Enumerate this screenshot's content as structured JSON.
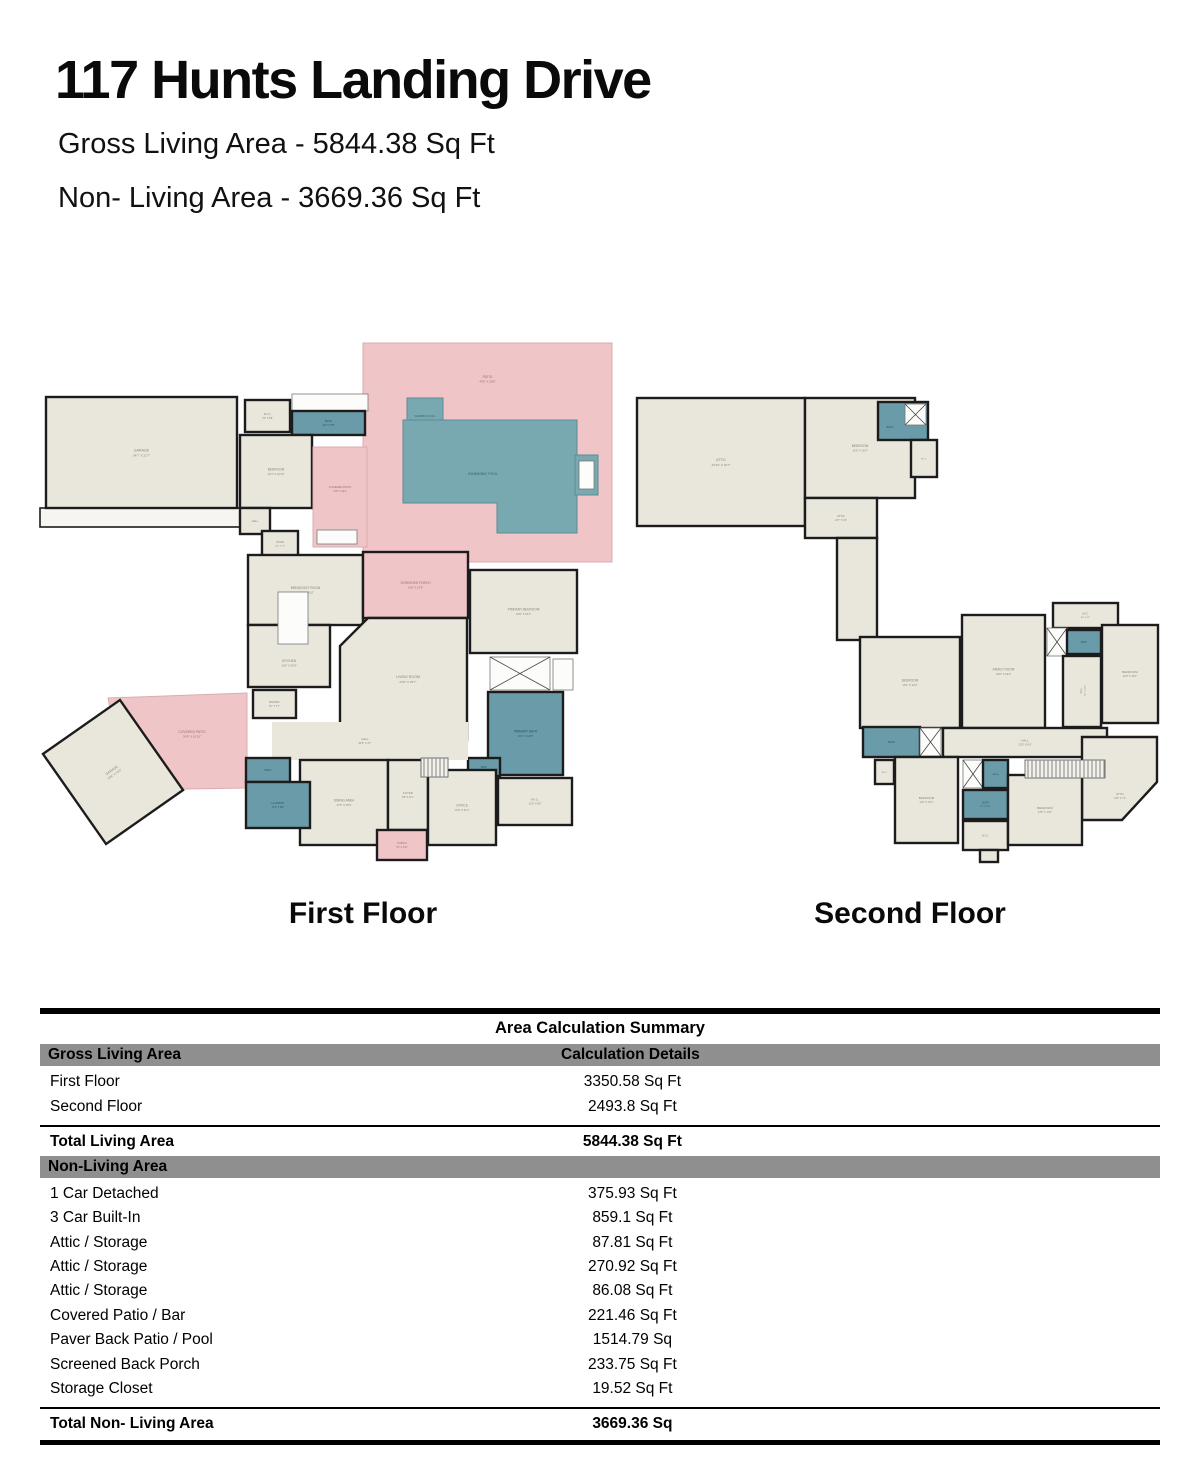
{
  "header": {
    "title": "117 Hunts Landing Drive",
    "gross": "Gross Living Area - 5844.38 Sq Ft",
    "nonliving": "Non- Living Area - 3669.36 Sq Ft"
  },
  "colors": {
    "wall": "#1c1c1c",
    "room_fill": "#e9e7dc",
    "bath_fill": "#699ca8",
    "pool_fill": "#79a9b0",
    "patio_fill": "#f0c5c8"
  },
  "plans": {
    "first": {
      "label": "First Floor",
      "shapes": [
        {
          "k": "patio",
          "x": 363,
          "y": 23,
          "w": 249,
          "h": 219,
          "n": "PATIO",
          "d": "43'6\" X 38'0\"",
          "ly": 58
        },
        {
          "k": "patio",
          "pts": "108,378 247,373 247,468 126,470",
          "n": "COVERED PATIO",
          "d": "24'8\" X 16'10\"",
          "lx": 192,
          "ly": 413
        },
        {
          "k": "pool",
          "x": 407,
          "y": 78,
          "w": 36,
          "h": 39,
          "n": "WARMING POOL",
          "fs": 2.6,
          "ly": 97
        },
        {
          "k": "pool",
          "pts": "403,100 577,100 577,213 497,213 497,183 403,183",
          "n": "SWIMMING POOL",
          "lx": 483,
          "ly": 155,
          "fs": 3.6
        },
        {
          "k": "pool",
          "x": 575,
          "y": 135,
          "w": 23,
          "h": 40
        },
        {
          "k": "white",
          "x": 579,
          "y": 141,
          "w": 15,
          "h": 28
        },
        {
          "k": "strip",
          "x": 40,
          "y": 188,
          "w": 205,
          "h": 19
        },
        {
          "k": "room",
          "x": 46,
          "y": 77,
          "w": 191,
          "h": 111,
          "n": "GARAGE",
          "d": "34'7\" X 22'7\"",
          "fs": 3.6
        },
        {
          "k": "room",
          "x": 245,
          "y": 80,
          "w": 45,
          "h": 32,
          "n": "W.I.C.",
          "d": "4'4\" X 5'8\"",
          "fs": 2.8
        },
        {
          "k": "white",
          "x": 292,
          "y": 74,
          "w": 76,
          "h": 17
        },
        {
          "k": "bath",
          "x": 292,
          "y": 91,
          "w": 73,
          "h": 24,
          "n": "BATH",
          "d": "10'4\" X 5'8\"",
          "fs": 2.8
        },
        {
          "k": "room",
          "x": 240,
          "y": 115,
          "w": 72,
          "h": 73,
          "n": "BEDROOM",
          "d": "12'4\" X 12'10\"",
          "fs": 3.2
        },
        {
          "k": "patio",
          "x": 313,
          "y": 127,
          "w": 54,
          "h": 100,
          "n": "COVERED PATIO",
          "d": "13'8\" X 16'4\"",
          "fs": 2.8,
          "ly": 168
        },
        {
          "k": "white",
          "x": 317,
          "y": 210,
          "w": 40,
          "h": 14
        },
        {
          "k": "room",
          "x": 240,
          "y": 188,
          "w": 30,
          "h": 26,
          "n": "HALL",
          "fs": 2.6
        },
        {
          "k": "room",
          "x": 262,
          "y": 211,
          "w": 36,
          "h": 26,
          "n": "ROOM",
          "d": "10'0\" X 7'5\"",
          "fs": 2.4
        },
        {
          "k": "room",
          "x": 248,
          "y": 235,
          "w": 115,
          "h": 70,
          "n": "BREAKFAST ROOM",
          "d": "16'5\" X 16'10\"",
          "fs": 3.2
        },
        {
          "k": "room",
          "x": 248,
          "y": 305,
          "w": 82,
          "h": 62,
          "n": "KITCHEN",
          "d": "16'4\" X 20'8\"",
          "fs": 3.2,
          "ly": 342
        },
        {
          "k": "room",
          "x": 253,
          "y": 370,
          "w": 43,
          "h": 28,
          "n": "PANTRY",
          "d": "8'7\" X 7'7\"",
          "fs": 2.8
        },
        {
          "k": "patioRoom",
          "x": 363,
          "y": 232,
          "w": 105,
          "h": 66,
          "n": "SCREENED PORCH",
          "d": "16'8\" X 13'9\"",
          "fs": 3.2
        },
        {
          "k": "room",
          "pts": "368,298 467,298 467,420 340,420 340,326",
          "n": "LIVING ROOM",
          "d": "23'6\" X 25'7\"",
          "lx": 408,
          "ly": 358,
          "fs": 3.6
        },
        {
          "k": "white",
          "x": 278,
          "y": 272,
          "w": 30,
          "h": 52
        },
        {
          "k": "room",
          "x": 470,
          "y": 250,
          "w": 107,
          "h": 83,
          "n": "PRIMARY BEDROOM",
          "d": "16'8\" X 15'2\"",
          "fs": 3.2
        },
        {
          "k": "white",
          "x": 490,
          "y": 337,
          "w": 60,
          "h": 33,
          "cross": true
        },
        {
          "k": "white",
          "x": 553,
          "y": 339,
          "w": 20,
          "h": 31
        },
        {
          "k": "bath",
          "x": 488,
          "y": 372,
          "w": 75,
          "h": 83,
          "n": "PRIMARY BATH",
          "d": "16'1\" X 13'8\"",
          "fs": 3.2
        },
        {
          "k": "bath",
          "x": 468,
          "y": 438,
          "w": 32,
          "h": 18,
          "n": "BATH",
          "fs": 2.4
        },
        {
          "k": "room",
          "x": 498,
          "y": 458,
          "w": 74,
          "h": 47,
          "n": "W.I.C.",
          "d": "12'5\" X 8'5\"",
          "fs": 3
        },
        {
          "k": "open",
          "x": 272,
          "y": 402,
          "w": 196,
          "h": 38
        },
        {
          "k": "room",
          "x": 300,
          "y": 440,
          "w": 88,
          "h": 85,
          "n": "DINING AREA",
          "d": "17'8\" X 15'5\"",
          "fs": 3.2
        },
        {
          "k": "room",
          "x": 388,
          "y": 440,
          "w": 40,
          "h": 70,
          "n": "FOYER",
          "d": "9'8\" X 11'1\"",
          "fs": 2.8
        },
        {
          "k": "room",
          "x": 428,
          "y": 450,
          "w": 68,
          "h": 75,
          "n": "OFFICE",
          "d": "12'8\" X 11'1\"",
          "fs": 3.2
        },
        {
          "k": "bath",
          "x": 246,
          "y": 438,
          "w": 44,
          "h": 24,
          "n": "BATH",
          "fs": 2.6
        },
        {
          "k": "bath",
          "x": 246,
          "y": 462,
          "w": 64,
          "h": 46,
          "n": "LAUNDRY",
          "d": "11'6\" X 8'8\"",
          "fs": 2.8
        },
        {
          "k": "patioRoom",
          "x": 377,
          "y": 510,
          "w": 50,
          "h": 30,
          "n": "PORCH",
          "d": "8'1\" X 2'10\"",
          "fs": 2.6
        },
        {
          "k": "stairs",
          "x": 421,
          "y": 438,
          "w": 27,
          "h": 19
        },
        {
          "k": "room",
          "x": 66,
          "y": 397,
          "w": 94,
          "h": 110,
          "rot": -35,
          "n": "GARAGE",
          "d": "19'8\" X 23'0\"",
          "fs": 3.4
        },
        {
          "k": "label",
          "lx": 365,
          "ly": 420,
          "n": "HALL",
          "d": "32'5\" X 4'7\"",
          "fs": 3
        }
      ]
    },
    "second": {
      "label": "Second Floor",
      "shapes": [
        {
          "k": "room",
          "x": 637,
          "y": 78,
          "w": 168,
          "h": 128,
          "n": "ATTIC",
          "d": "34'10\" X 22'7\"",
          "fs": 3.6
        },
        {
          "k": "room",
          "x": 805,
          "y": 78,
          "w": 110,
          "h": 100,
          "n": "BEDROOM",
          "d": "16'6\" X 16'4\"",
          "fs": 3.2
        },
        {
          "k": "bath",
          "x": 878,
          "y": 82,
          "w": 50,
          "h": 38,
          "n": "BATH",
          "fs": 2.6,
          "lx": 890,
          "ly": 108
        },
        {
          "k": "white",
          "x": 905,
          "y": 84,
          "w": 21,
          "h": 21,
          "cross": true
        },
        {
          "k": "room",
          "x": 911,
          "y": 120,
          "w": 26,
          "h": 37,
          "n": "W.I.C.",
          "fs": 2.2
        },
        {
          "k": "room",
          "x": 805,
          "y": 178,
          "w": 72,
          "h": 40,
          "n": "ATTIC",
          "d": "13'7\" X 4'3\"",
          "fs": 2.8
        },
        {
          "k": "room",
          "x": 837,
          "y": 218,
          "w": 40,
          "h": 102
        },
        {
          "k": "room",
          "x": 860,
          "y": 317,
          "w": 100,
          "h": 91,
          "n": "BEDROOM",
          "d": "16'1\" X 12'2\"",
          "fs": 3.2
        },
        {
          "k": "room",
          "x": 962,
          "y": 295,
          "w": 83,
          "h": 113,
          "n": "FAMILY ROOM",
          "d": "14'8\" X 19'0\"",
          "fs": 3.2
        },
        {
          "k": "room",
          "x": 1053,
          "y": 283,
          "w": 65,
          "h": 25,
          "n": "W.I.C.",
          "d": "9'8\" X 4'5\"",
          "fs": 2.4
        },
        {
          "k": "white",
          "x": 1047,
          "y": 308,
          "w": 20,
          "h": 28,
          "cross": true
        },
        {
          "k": "bath",
          "x": 1067,
          "y": 310,
          "w": 34,
          "h": 24,
          "n": "BATH",
          "fs": 2.4
        },
        {
          "k": "room",
          "x": 1102,
          "y": 305,
          "w": 56,
          "h": 98,
          "n": "BEDROOM",
          "d": "12'9\" X 16'1\"",
          "fs": 3
        },
        {
          "k": "room",
          "x": 1063,
          "y": 336,
          "w": 38,
          "h": 71,
          "n": "HALL",
          "d": "3'10\" X 12'4\"",
          "fs": 2.4,
          "rotLabel": -90
        },
        {
          "k": "room",
          "x": 943,
          "y": 408,
          "w": 164,
          "h": 29,
          "n": "HALL",
          "d": "20'3\" X 6'4\"",
          "fs": 3
        },
        {
          "k": "bath",
          "x": 863,
          "y": 407,
          "w": 57,
          "h": 30,
          "n": "BATH",
          "fs": 2.6
        },
        {
          "k": "white",
          "x": 920,
          "y": 408,
          "w": 21,
          "h": 28,
          "cross": true
        },
        {
          "k": "room",
          "x": 875,
          "y": 440,
          "w": 19,
          "h": 24,
          "n": "W.I.C.",
          "fs": 2
        },
        {
          "k": "room",
          "x": 895,
          "y": 437,
          "w": 63,
          "h": 86,
          "n": "BEDROOM",
          "d": "11'6\" X 13'1\"",
          "fs": 3
        },
        {
          "k": "white",
          "x": 963,
          "y": 440,
          "w": 20,
          "h": 28,
          "cross": true
        },
        {
          "k": "bath",
          "x": 983,
          "y": 440,
          "w": 25,
          "h": 28,
          "n": "BATH",
          "fs": 2.2
        },
        {
          "k": "bath",
          "x": 963,
          "y": 470,
          "w": 45,
          "h": 29,
          "n": "BATH",
          "d": "8'2\" X 5'10\"",
          "fs": 2.4
        },
        {
          "k": "room",
          "x": 963,
          "y": 501,
          "w": 45,
          "h": 29,
          "n": "W.I.C.",
          "fs": 2.6
        },
        {
          "k": "room",
          "x": 980,
          "y": 530,
          "w": 18,
          "h": 12
        },
        {
          "k": "room",
          "pts": "1082,417 1157,417 1157,462 1122,500 1082,500",
          "n": "ATTIC",
          "d": "14'5\" X 7'3\"",
          "lx": 1120,
          "ly": 475,
          "fs": 2.8
        },
        {
          "k": "room",
          "x": 1008,
          "y": 455,
          "w": 74,
          "h": 70,
          "n": "BEDROOM",
          "d": "13'6\" X 13'1\"",
          "fs": 3
        },
        {
          "k": "stairs",
          "x": 1025,
          "y": 440,
          "w": 80,
          "h": 18
        }
      ]
    }
  },
  "table": {
    "title": "Area Calculation Summary",
    "sections": [
      {
        "header": "Gross Living Area",
        "header2": "Calculation Details",
        "rows": [
          {
            "label": "First Floor",
            "value": "3350.58 Sq Ft"
          },
          {
            "label": "Second Floor",
            "value": "2493.8 Sq Ft"
          }
        ],
        "total": {
          "label": "Total Living Area",
          "value": "5844.38 Sq Ft"
        }
      },
      {
        "header": "Non-Living Area",
        "header2": "",
        "rows": [
          {
            "label": "1 Car Detached",
            "value": "375.93 Sq Ft"
          },
          {
            "label": "3 Car Built-In",
            "value": "859.1 Sq Ft"
          },
          {
            "label": "Attic / Storage",
            "value": "87.81 Sq Ft"
          },
          {
            "label": "Attic / Storage",
            "value": "270.92 Sq Ft"
          },
          {
            "label": "Attic / Storage",
            "value": "86.08 Sq Ft"
          },
          {
            "label": "Covered Patio / Bar",
            "value": "221.46 Sq Ft"
          },
          {
            "label": "Paver Back Patio / Pool",
            "value": "1514.79 Sq"
          },
          {
            "label": "Screened Back Porch",
            "value": "233.75 Sq Ft"
          },
          {
            "label": "Storage Closet",
            "value": "19.52 Sq Ft"
          }
        ],
        "total": {
          "label": "Total Non- Living Area",
          "value": "3669.36 Sq"
        }
      }
    ]
  }
}
